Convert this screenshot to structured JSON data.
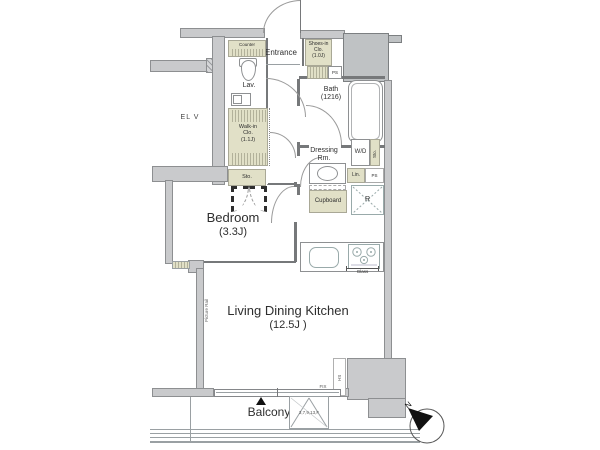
{
  "labels": {
    "elevator": "EL V",
    "entrance": "Entrance",
    "counter": "Counter",
    "lavatory": "Lav.",
    "picture_rail": "Picture Rail",
    "hs": "HS",
    "fix": "FIX",
    "glass": "Glass",
    "north": "N",
    "balcony": "Balcony",
    "hatch_floors": "3,7,9,13,F",
    "ps_top": "PS",
    "ps_mid": "PS",
    "linen": "Lin.",
    "washer_dryer": "W/D",
    "wd_storage": "Sto.",
    "storage": "Sto.",
    "refrigerator": "R",
    "cupboard": "Cupboard"
  },
  "rooms": {
    "bedroom": {
      "name": "Bedroom",
      "size": "(3.3J)"
    },
    "ldk": {
      "name": "Living Dining Kitchen",
      "size": "(12.5J )"
    },
    "bath": {
      "name": "Bath",
      "size": "(1216)"
    },
    "dressing": {
      "lines": [
        "Dressing",
        "Rm."
      ]
    },
    "walkin": {
      "lines": [
        "Walk-in",
        "Clo.",
        "(1.1J)"
      ]
    },
    "shoes": {
      "lines": [
        "Shoes-in",
        "Clo.",
        "(1.0J)"
      ]
    }
  },
  "colors": {
    "wall": "#c9cacc",
    "wall2": "#bfc2c4",
    "outline": "#8d8f91",
    "part": "#76787a",
    "cab": "#e1e0c7",
    "cabb": "#a9a896",
    "arc": "#9a9a9a",
    "text": "#2e2e2e"
  }
}
